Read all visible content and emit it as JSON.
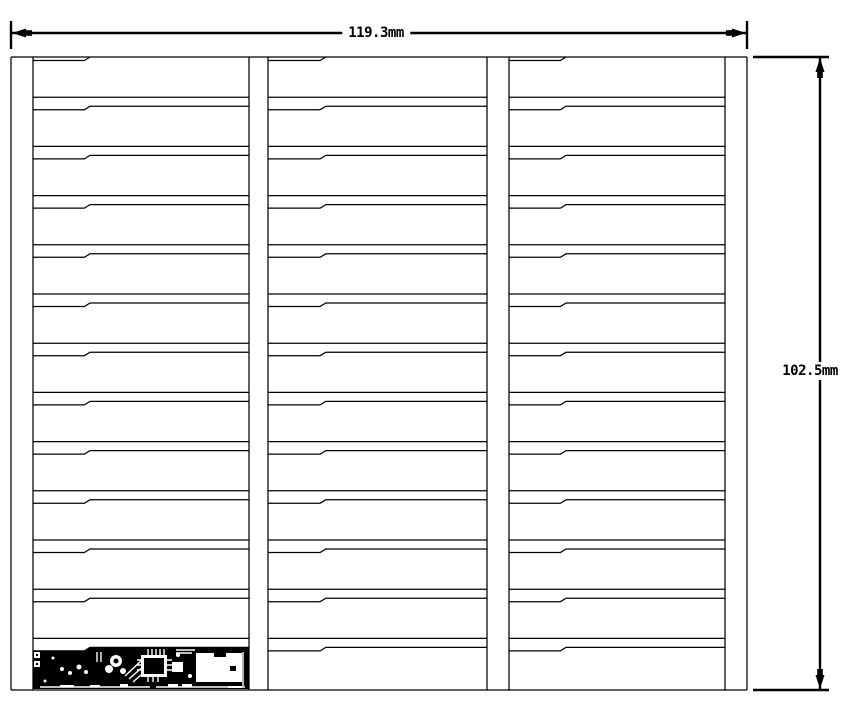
{
  "drawing": {
    "type": "panel-dimension-drawing",
    "width_label": "119.3mm",
    "height_label": "102.5mm"
  },
  "geometry": {
    "panel": {
      "left": 11,
      "top": 57,
      "right": 747,
      "bottom": 690
    },
    "edge_strips": [
      {
        "x0": 11,
        "x1": 33
      },
      {
        "x0": 725,
        "x1": 747
      }
    ],
    "columns": [
      {
        "x0": 33,
        "x1": 249
      },
      {
        "x0": 268,
        "x1": 487
      },
      {
        "x0": 509,
        "x1": 725
      }
    ],
    "rows": 13,
    "row_pitch": 49.2,
    "step_frac_start": 0.238,
    "step_frac_end": 0.264,
    "step_drop": 3.5,
    "bottom_line_offset": 9,
    "line_width_thin": 1.25,
    "line_width_dim": 2.4,
    "dim_top": {
      "y": 33,
      "ext_top": 21,
      "ext_bottom": 49,
      "label_cx": 376,
      "label_cy": 33
    },
    "dim_right": {
      "x": 820,
      "ext_left": 753,
      "ext_right": 829,
      "label_cx": 810,
      "label_cy": 371
    }
  },
  "pcb": {
    "base_polygon": "33,651.5 84,651.5 89,648 249,648 249,689 33,689",
    "white_rects": [
      [
        34,
        652,
        6,
        6
      ],
      [
        34,
        661,
        6,
        6
      ],
      [
        172,
        662,
        11,
        10
      ],
      [
        196,
        653,
        46,
        29
      ],
      [
        60,
        685,
        14,
        2.5
      ],
      [
        90,
        685,
        10,
        2.5
      ],
      [
        120,
        684,
        8,
        2.5
      ],
      [
        168,
        684,
        10,
        2.5
      ],
      [
        182,
        684,
        10,
        2.5
      ],
      [
        228,
        686,
        14,
        2
      ]
    ],
    "white_circles": [
      [
        62,
        669,
        2
      ],
      [
        70,
        673,
        2
      ],
      [
        79,
        667,
        2.5
      ],
      [
        86,
        672,
        2
      ],
      [
        45,
        681,
        1.5
      ],
      [
        53,
        658,
        1.5
      ],
      [
        116,
        661,
        6
      ],
      [
        109,
        669,
        4
      ],
      [
        123,
        671,
        3
      ],
      [
        178,
        655,
        2
      ],
      [
        190,
        676,
        2
      ]
    ],
    "white_lines": [
      [
        40,
        687,
        150,
        687
      ],
      [
        156,
        687,
        245,
        687
      ],
      [
        125,
        676,
        141,
        661
      ],
      [
        129,
        679,
        146,
        664
      ],
      [
        133,
        682,
        150,
        667
      ],
      [
        137,
        660,
        141,
        660
      ],
      [
        137,
        665,
        141,
        665
      ],
      [
        137,
        670,
        141,
        670
      ],
      [
        167,
        660,
        172,
        660
      ],
      [
        167,
        665,
        172,
        665
      ],
      [
        167,
        670,
        172,
        670
      ],
      [
        148,
        649,
        148,
        655
      ],
      [
        152,
        649,
        152,
        655
      ],
      [
        156,
        649,
        156,
        655
      ],
      [
        160,
        649,
        160,
        655
      ],
      [
        164,
        649,
        164,
        655
      ],
      [
        148,
        677,
        148,
        682
      ],
      [
        153,
        677,
        153,
        682
      ],
      [
        158,
        677,
        158,
        682
      ],
      [
        243,
        652,
        243,
        686
      ],
      [
        97,
        652,
        97,
        662
      ],
      [
        101,
        652,
        101,
        662
      ],
      [
        176,
        650,
        195,
        650
      ],
      [
        176,
        653,
        192,
        653
      ]
    ],
    "ic_white": [
      141,
      655,
      26,
      22
    ],
    "ic_black": [
      144,
      658,
      20,
      16
    ],
    "black_rects": [
      [
        214,
        648,
        12,
        9
      ],
      [
        230,
        666,
        6,
        5
      ],
      [
        36,
        654,
        2,
        2
      ],
      [
        36,
        663,
        2,
        2
      ]
    ],
    "black_circles": [
      [
        116,
        661,
        2.5
      ]
    ]
  }
}
